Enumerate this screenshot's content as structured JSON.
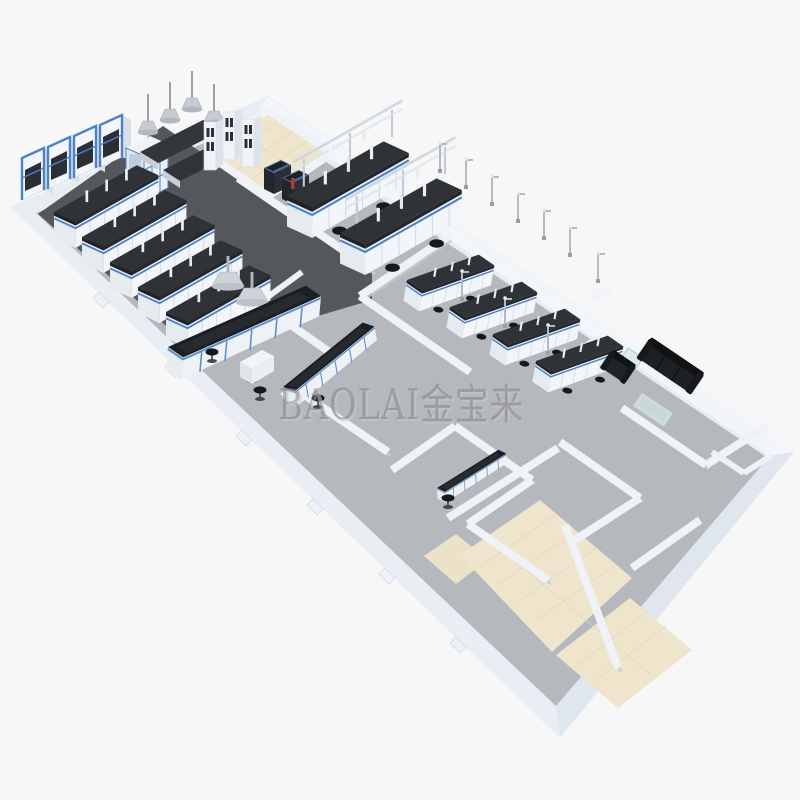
{
  "watermark": {
    "text": "BAOLAI金宝来"
  },
  "colors": {
    "background": "#f7f7f8",
    "shell_wall": "#e8edf3",
    "wall_top": "#f1f4f7",
    "floor_gray": "#b5b9bd",
    "floor_dark_lab": "#55585d",
    "floor_beige": "#efe5cd",
    "bench_top": "#2f3337",
    "bench_base": "#eef1f5",
    "accent_blue": "#4d82c4",
    "sofa_black": "#1b1d20",
    "watermark_gray": "#8d8d92"
  },
  "scene": {
    "type": "isometric-3d-laboratory-floor-plan-render",
    "regions": [
      "fume-hood-lab",
      "central-instrument-lab",
      "bench-lab",
      "corridor",
      "lounge",
      "small-lab-room",
      "beige-tiled-rooms"
    ]
  }
}
